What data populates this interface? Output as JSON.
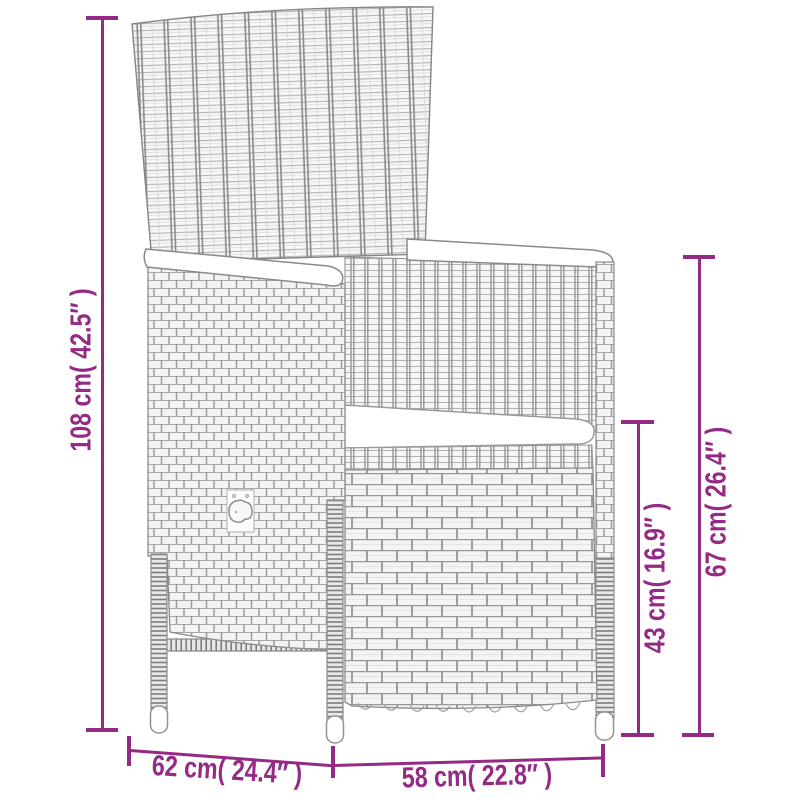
{
  "colors": {
    "accent": "#952a85",
    "line_art": "#858585",
    "background": "#ffffff"
  },
  "diagram": {
    "type": "product-dimension-diagram",
    "subject": "poly rattan reclining garden chair with cushions",
    "dimensions": {
      "total_height": "108 cm( 42.5″ )",
      "back_post_height": "67 cm( 26.4″ )",
      "seat_section_height": "43 cm( 16.9″ )",
      "depth": "62 cm( 24.4″ )",
      "width": "58 cm( 22.8″ )"
    }
  }
}
